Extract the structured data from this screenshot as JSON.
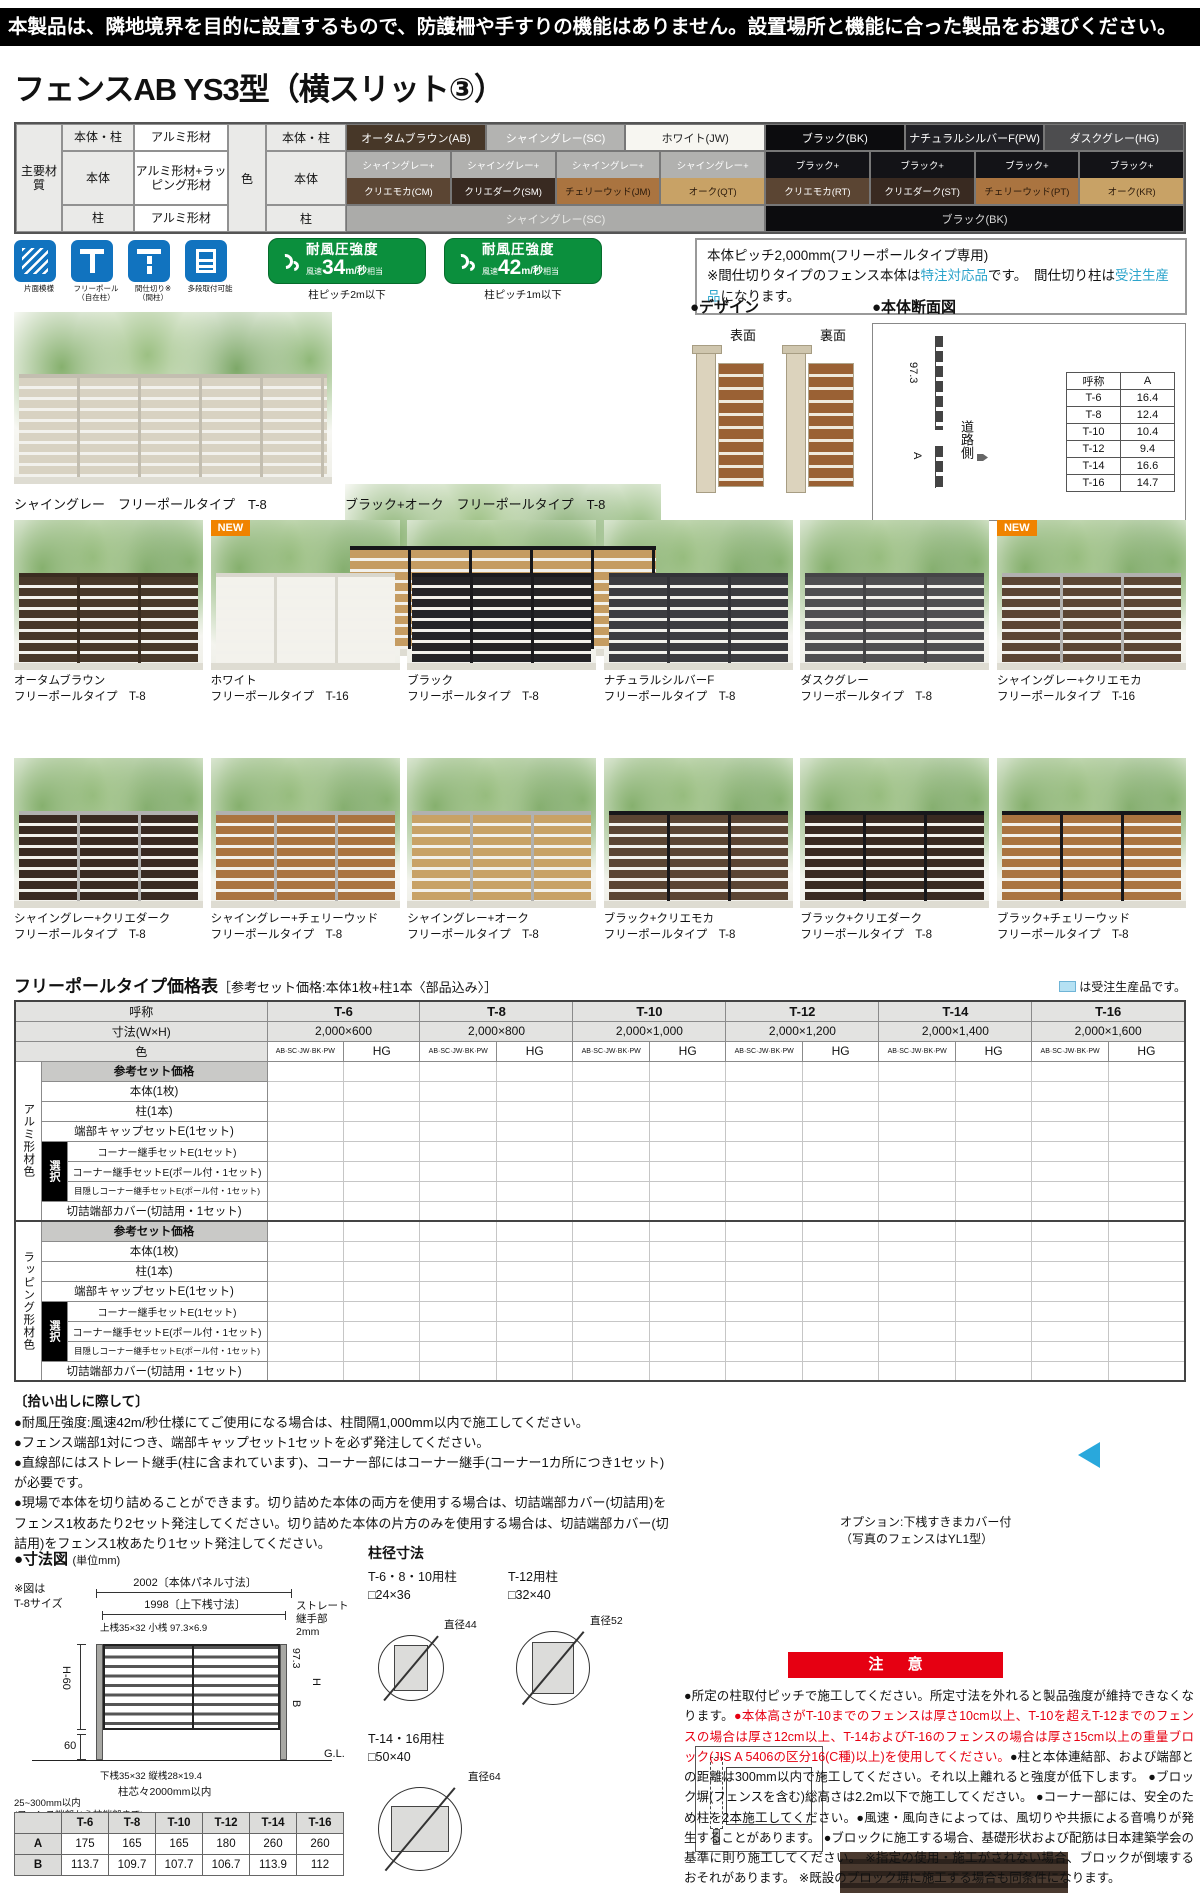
{
  "page": {
    "warning": "本製品は、隣地境界を目的に設置するもので、防護柵や手すりの機能はありません。設置場所と機能に合った製品をお選びください。",
    "title": "フェンスAB YS3型（横スリット③）"
  },
  "spec": {
    "main_header": "主要材質",
    "rows": [
      {
        "label": "本体・柱",
        "value": "アルミ形材"
      },
      {
        "label": "本体",
        "value": "アルミ形材+ラッピング形材"
      },
      {
        "label": "柱",
        "value": "アルミ形材"
      }
    ],
    "color_header": "色",
    "row1_label": "本体・柱",
    "row2_label": "本体",
    "row3_label": "柱",
    "singles": [
      {
        "name": "オータムブラウン(AB)",
        "bg": "#473728",
        "fg": "#ffffff"
      },
      {
        "name": "シャイングレー(SC)",
        "bg": "#b3b3b1",
        "fg": "#ffffff"
      },
      {
        "name": "ホワイト(JW)",
        "bg": "#f7f6f1",
        "fg": "#222222"
      },
      {
        "name": "ブラック(BK)",
        "bg": "#0c0c0e",
        "fg": "#ffffff"
      },
      {
        "name": "ナチュラルシルバーF(PW)",
        "bg": "#212126",
        "fg": "#ffffff"
      },
      {
        "name": "ダスクグレー(HG)",
        "bg": "#4d4d4f",
        "fg": "#ffffff"
      }
    ],
    "combos": [
      {
        "top": {
          "name": "シャイングレー+",
          "bg": "#b1b1af",
          "fg": "#ffffff"
        },
        "wood": {
          "name": "クリエモカ(CM)",
          "bg": "#5b4533",
          "fg": "#ffffff"
        }
      },
      {
        "top": {
          "name": "シャイングレー+",
          "bg": "#b1b1af",
          "fg": "#ffffff"
        },
        "wood": {
          "name": "クリエダーク(SM)",
          "bg": "#392a21",
          "fg": "#ffffff"
        }
      },
      {
        "top": {
          "name": "シャイングレー+",
          "bg": "#b1b1af",
          "fg": "#ffffff"
        },
        "wood": {
          "name": "チェリーウッド(JM)",
          "bg": "#aa7440",
          "fg": "#2b1a0b"
        }
      },
      {
        "top": {
          "name": "シャイングレー+",
          "bg": "#b1b1af",
          "fg": "#ffffff"
        },
        "wood": {
          "name": "オーク(QT)",
          "bg": "#c8a266",
          "fg": "#2b1a0b"
        }
      },
      {
        "top": {
          "name": "ブラック+",
          "bg": "#131317",
          "fg": "#ffffff"
        },
        "wood": {
          "name": "クリエモカ(RT)",
          "bg": "#5b4533",
          "fg": "#ffffff"
        }
      },
      {
        "top": {
          "name": "ブラック+",
          "bg": "#131317",
          "fg": "#ffffff"
        },
        "wood": {
          "name": "クリエダーク(ST)",
          "bg": "#392a21",
          "fg": "#ffffff"
        }
      },
      {
        "top": {
          "name": "ブラック+",
          "bg": "#131317",
          "fg": "#ffffff"
        },
        "wood": {
          "name": "チェリーウッド(PT)",
          "bg": "#aa7440",
          "fg": "#2b1a0b"
        }
      },
      {
        "top": {
          "name": "ブラック+",
          "bg": "#131317",
          "fg": "#ffffff"
        },
        "wood": {
          "name": "オーク(KR)",
          "bg": "#c8a266",
          "fg": "#2b1a0b"
        }
      }
    ],
    "posts": [
      {
        "name": "シャイングレー(SC)",
        "bg": "#ababa9",
        "fg": "#e9e9e7"
      },
      {
        "name": "ブラック(BK)",
        "bg": "#0c0c0e",
        "fg": "#d9d9d9"
      }
    ]
  },
  "features": {
    "icons": [
      {
        "label": "片面模様"
      },
      {
        "label": "フリーポール（自在柱）"
      },
      {
        "label": "間仕切り※（間柱）"
      },
      {
        "label": "多段取付可能"
      }
    ],
    "badges": [
      {
        "title": "耐風圧強度",
        "prefix": "風速",
        "value": "34",
        "unit": "m/秒",
        "suffix": "相当",
        "note": "柱ピッチ2m以下"
      },
      {
        "title": "耐風圧強度",
        "prefix": "風速",
        "value": "42",
        "unit": "m/秒",
        "suffix": "相当",
        "note": "柱ピッチ1m以下"
      }
    ],
    "info": {
      "line1": "本体ピッチ2,000mm(フリーポールタイプ専用)",
      "line2_pre": "※間仕切りタイプのフェンス本体は",
      "line2_hl": "特注対応品",
      "line2_post": "です。",
      "line3_pre": "　間仕切り柱は",
      "line3_hl": "受注生産品",
      "line3_post": "になります。"
    }
  },
  "hero": [
    {
      "caption": "シャイングレー　フリーポールタイプ　T-8",
      "slat": "#d8d2c2",
      "frame": "#c3beb0"
    },
    {
      "caption": "ブラック+オーク　フリーポールタイプ　T-8",
      "slat": "#c59c62",
      "frame": "#17171a"
    }
  ],
  "design": {
    "title": "●デザイン",
    "front": "表面",
    "back": "裏面"
  },
  "xsec": {
    "title": "●本体断面図",
    "dim": "97.3",
    "a_label": "A",
    "road": "道路側",
    "headers": [
      "呼称",
      "A"
    ],
    "rows": [
      [
        "T-6",
        "16.4"
      ],
      [
        "T-8",
        "12.4"
      ],
      [
        "T-10",
        "10.4"
      ],
      [
        "T-12",
        "9.4"
      ],
      [
        "T-14",
        "16.6"
      ],
      [
        "T-16",
        "14.7"
      ]
    ]
  },
  "grid1": [
    {
      "line1": "オータムブラウン",
      "line2": "フリーポールタイプ　T-8",
      "slat": "#473728",
      "frame": "#3a2d20"
    },
    {
      "line1": "ホワイト",
      "line2": "フリーポールタイプ　T-16",
      "slat": "#f3f2ec",
      "frame": "#d9d7cd",
      "badge": "NEW"
    },
    {
      "line1": "ブラック",
      "line2": "フリーポールタイプ　T-8",
      "slat": "#242427",
      "frame": "#1b1b1e"
    },
    {
      "line1": "ナチュラルシルバーF",
      "line2": "フリーポールタイプ　T-8",
      "slat": "#3c3c40",
      "frame": "#333338"
    },
    {
      "line1": "ダスクグレー",
      "line2": "フリーポールタイプ　T-8",
      "slat": "#4f4f51",
      "frame": "#454547"
    },
    {
      "line1": "シャイングレー+クリエモカ",
      "line2": "フリーポールタイプ　T-16",
      "slat": "#5b4533",
      "frame": "#b1b1af",
      "badge": "NEW"
    }
  ],
  "grid2": [
    {
      "line1": "シャイングレー+クリエダーク",
      "line2": "フリーポールタイプ　T-8",
      "slat": "#392a21",
      "frame": "#b1b1af"
    },
    {
      "line1": "シャイングレー+チェリーウッド",
      "line2": "フリーポールタイプ　T-8",
      "slat": "#aa7440",
      "frame": "#b1b1af"
    },
    {
      "line1": "シャイングレー+オーク",
      "line2": "フリーポールタイプ　T-8",
      "slat": "#c8a266",
      "frame": "#b1b1af"
    },
    {
      "line1": "ブラック+クリエモカ",
      "line2": "フリーポールタイプ　T-8",
      "slat": "#5b4533",
      "frame": "#17171a"
    },
    {
      "line1": "ブラック+クリエダーク",
      "line2": "フリーポールタイプ　T-8",
      "slat": "#392a21",
      "frame": "#17171a"
    },
    {
      "line1": "ブラック+チェリーウッド",
      "line2": "フリーポールタイプ　T-8",
      "slat": "#aa7440",
      "frame": "#17171a"
    }
  ],
  "price": {
    "title": "フリーポールタイプ価格表",
    "subtitle": "［参考セット価格:本体1枚+柱1本〈部品込み〉］",
    "legend": "は受注生産品です。",
    "name_header": "呼称",
    "cols": [
      "T-6",
      "T-8",
      "T-10",
      "T-12",
      "T-14",
      "T-16"
    ],
    "size_header": "寸法(W×H)",
    "sizes": [
      "2,000×600",
      "2,000×800",
      "2,000×1,000",
      "2,000×1,200",
      "2,000×1,400",
      "2,000×1,600"
    ],
    "color_header": "色",
    "color_a": "AB·SC·JW·BK·PW",
    "color_b": "HG",
    "group1": "アルミ形材色",
    "group2": "ラッピング形材色",
    "set_header": "参考セット価格",
    "rows": [
      "本体(1枚)",
      "柱(1本)",
      "端部キャップセットE(1セット)"
    ],
    "select_label": "選択",
    "select_rows": [
      "コーナー継手セットE(1セット)",
      "コーナー継手セットE(ポール付・1セット)",
      "目隠しコーナー継手セットE(ポール付・1セット)"
    ],
    "last_row": "切詰端部カバー(切詰用・1セット)"
  },
  "notes": {
    "title": "〔拾い出しに際して〕",
    "items": [
      "●耐風圧強度:風速42m/秒仕様にてご使用になる場合は、柱間隔1,000mm以内で施工してください。",
      "●フェンス端部1対につき、端部キャップセット1セットを必ず発注してください。",
      "●直線部にはストレート継手(柱に含まれています)、コーナー部にはコーナー継手(コーナー1カ所につき1セット)が必要です。",
      "●現場で本体を切り詰めることができます。切り詰めた本体の両方を使用する場合は、切詰端部カバー(切詰用)をフェンス1枚あたり2セット発注してください。切り詰めた本体の片方のみを使用する場合は、切詰端部カバー(切詰用)をフェンス1枚あたり1セット発注してください。"
    ]
  },
  "option": {
    "caption1": "オプション:下桟すきまカバー付",
    "caption2": "（写真のフェンスはYL1型）"
  },
  "dims": {
    "title": "●寸法図",
    "unit": "(単位mm)",
    "note1": "※図は",
    "note2": "T-8サイズ",
    "d1": "2002〔本体パネル寸法〕",
    "d2": "1998〔上下桟寸法〕",
    "joint1": "ストレート継手部",
    "joint2": "2mm",
    "rail_top": "上桟35×32 小桟 97.3×6.9",
    "h60": "H-60",
    "v60": "60",
    "v973": "97.3",
    "b": "B",
    "h": "H",
    "gl": "G.L.",
    "rail_bottom": "下桟35×32 縦桟28×19.4",
    "pitch": "柱芯々2000mm以内",
    "edge1": "25~300mm以内",
    "edge2": "(フェンス端部から柱端部まで)"
  },
  "postdia": {
    "title": "柱径寸法",
    "items": [
      {
        "name": "T-6・8・10用柱",
        "size": "□24×36",
        "dia": "直径44"
      },
      {
        "name": "T-12用柱",
        "size": "□32×40",
        "dia": "直径52"
      },
      {
        "name": "T-14・16用柱",
        "size": "□50×40",
        "dia": "直径64"
      }
    ]
  },
  "abtable": {
    "headers": [
      "T-6",
      "T-8",
      "T-10",
      "T-12",
      "T-14",
      "T-16"
    ],
    "row_a_label": "A",
    "row_a": [
      "175",
      "165",
      "165",
      "180",
      "260",
      "260"
    ],
    "row_b_label": "B",
    "row_b": [
      "113.7",
      "109.7",
      "107.7",
      "106.7",
      "113.9",
      "112"
    ]
  },
  "caution": {
    "title": "注 意",
    "p1": "●所定の柱取付ピッチで施工してください。所定寸法を外れると製品強度が維持できなくなります。",
    "p2": "●本体高さがT-10までのフェンスは厚さ10cm以上、T-10を超えT-12までのフェンスの場合は厚さ12cm以上、T-14およびT-16のフェンスの場合は厚さ15cm以上の重量ブロック(JIS A 5406の区分16(C種)以上)を使用してください。",
    "p3": "●柱と本体連結部、および端部との距離は300mm以内で施工してください。それ以上離れると強度が低下します。 ●ブロック塀(フェンスを含む)総高さは2.2m以下で施工してください。 ●コーナー部には、安全のため柱を2本施工してください。●風速・風向きによっては、風切りや共振による音鳴りが発生することがあります。 ●ブロックに施工する場合、基礎形状および配筋は日本建築学会の基準に則り施工してください。 ※指定の使用・施工がされない場合、ブロックが倒壊するおそれがあります。 ※既設のブロック塀に施工する場合も同条件になります。"
  }
}
